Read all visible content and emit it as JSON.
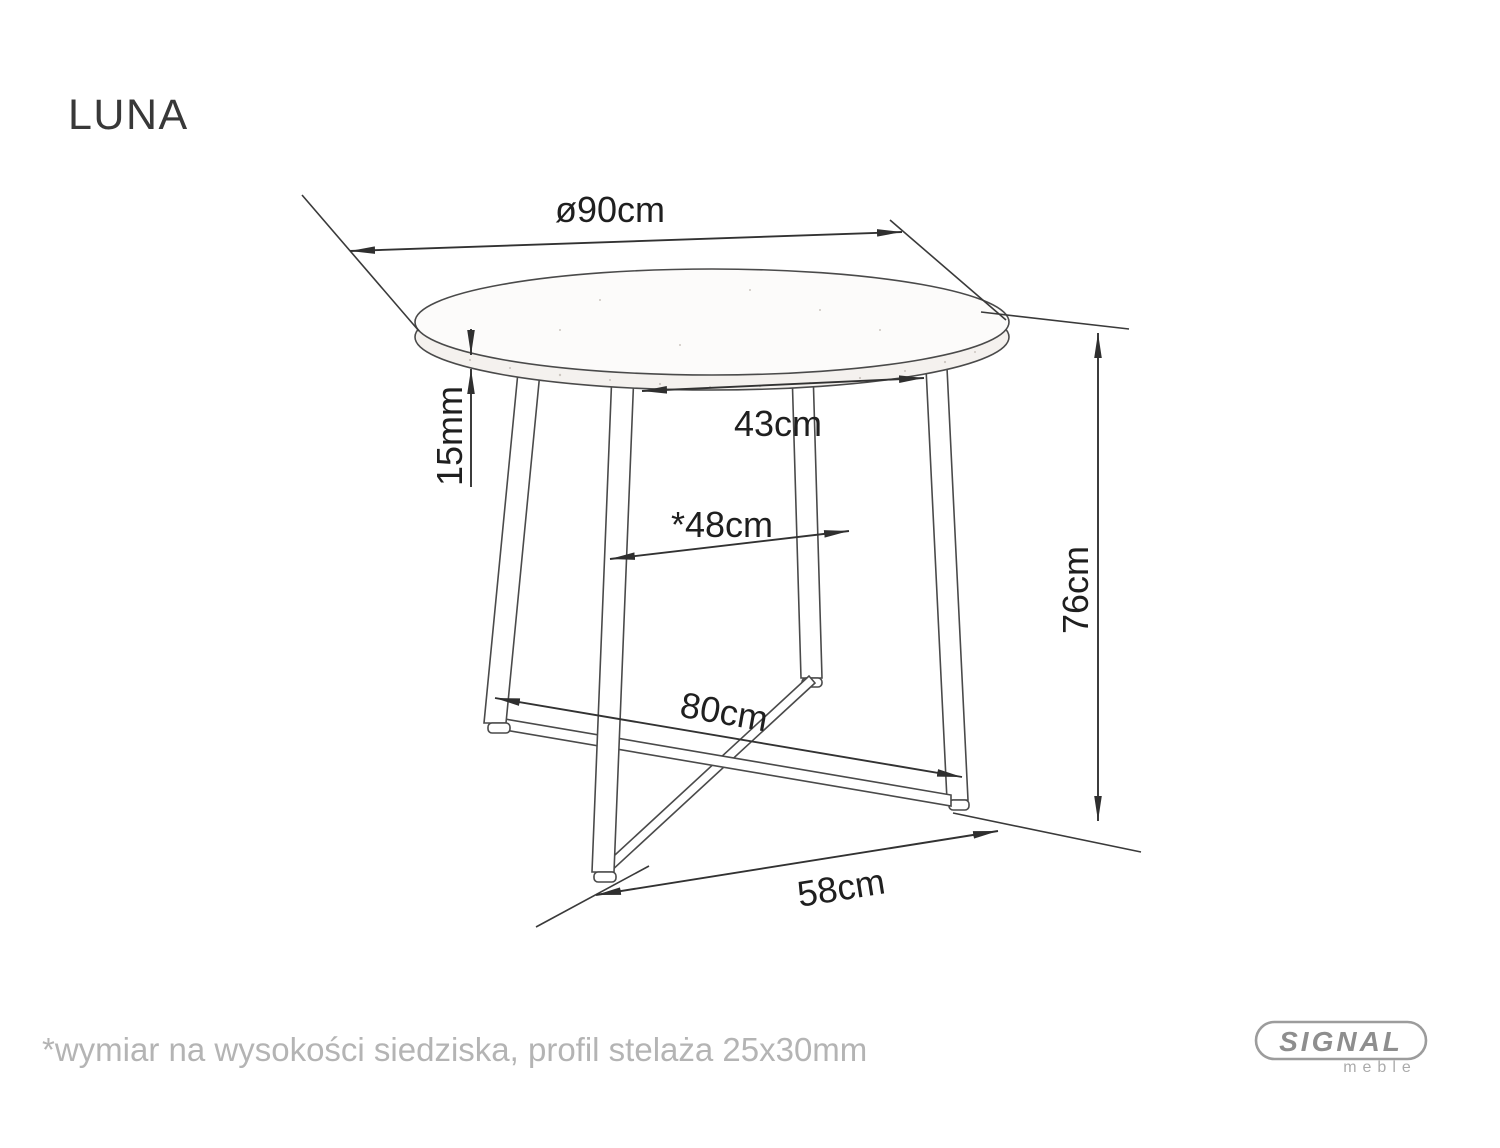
{
  "title": "LUNA",
  "dims": {
    "diameter": "ø90cm",
    "top_thickness": "15mm",
    "frame_top_width": "43cm",
    "seat_level_width": "*48cm",
    "height": "76cm",
    "base_length": "80cm",
    "base_width": "58cm"
  },
  "footnote": "*wymiar na wysokości siedziska, profil stelaża 25x30mm",
  "logo": {
    "brand": "SIGNAL",
    "subtitle": "meble"
  },
  "colors": {
    "line": "#3a3a3a",
    "dim_text": "#1f1f1f",
    "muted_text": "#b4b4b4",
    "logo_gray": "#8e8e8e",
    "background": "#ffffff"
  }
}
